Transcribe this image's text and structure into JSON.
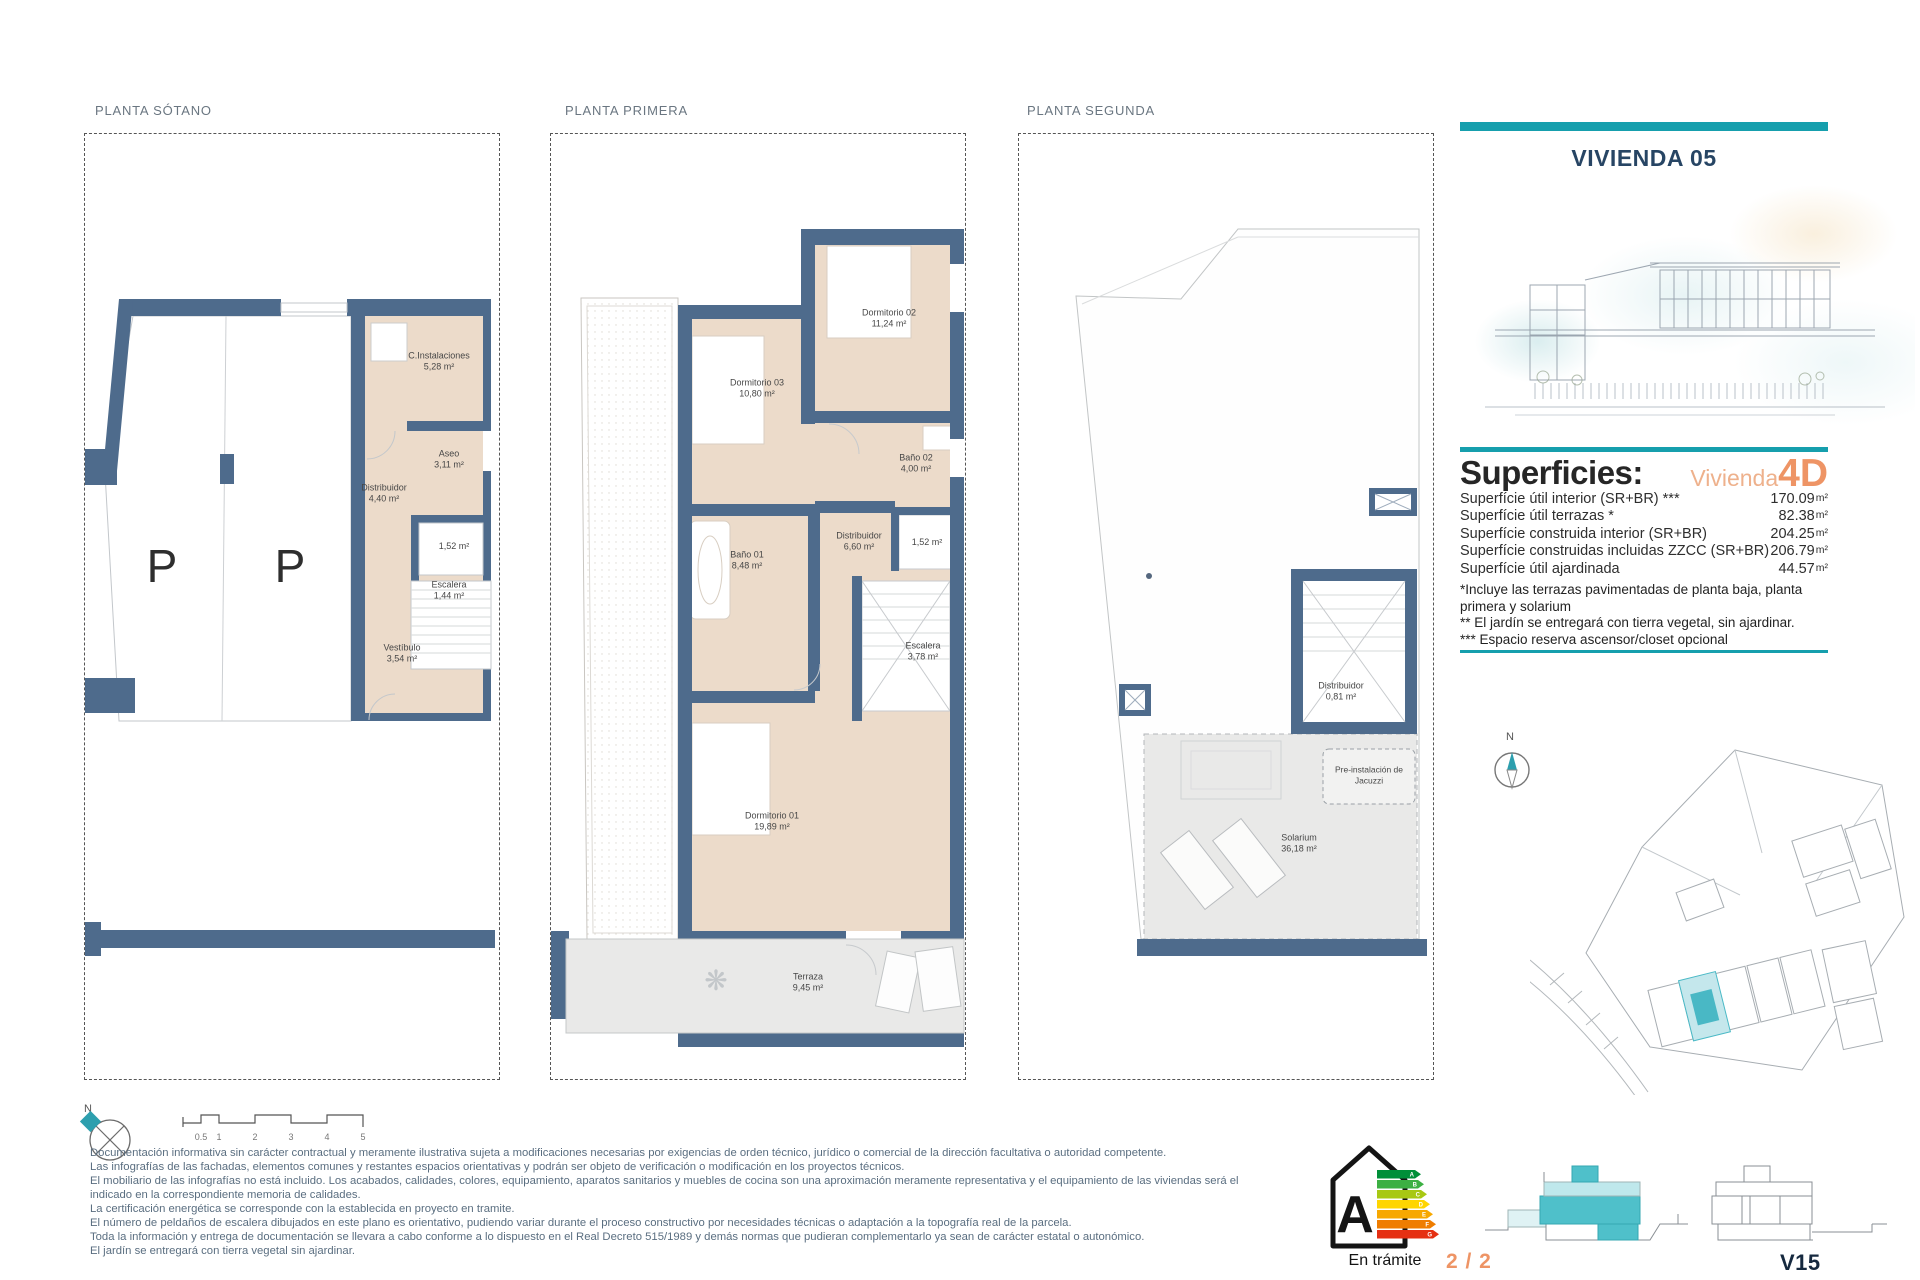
{
  "header": {
    "title": "VIVIENDA 05"
  },
  "plans": [
    {
      "title": "PLANTA SÓTANO",
      "rooms": [
        {
          "name": "C.Instalaciones",
          "area": "5,28 m²"
        },
        {
          "name": "Aseo",
          "area": "3,11 m²"
        },
        {
          "name": "Distribuidor",
          "area": "4,40 m²"
        },
        {
          "name": "",
          "area": "1,52 m²"
        },
        {
          "name": "Escalera",
          "area": "1,44 m²"
        },
        {
          "name": "Vestíbulo",
          "area": "3,54 m²"
        }
      ],
      "parking_marks": [
        "P",
        "P"
      ]
    },
    {
      "title": "PLANTA PRIMERA",
      "rooms": [
        {
          "name": "Dormitorio 02",
          "area": "11,24 m²"
        },
        {
          "name": "Dormitorio 03",
          "area": "10,80 m²"
        },
        {
          "name": "Baño 02",
          "area": "4,00 m²"
        },
        {
          "name": "Distribuidor",
          "area": "6,60 m²"
        },
        {
          "name": "",
          "area": "1,52 m²"
        },
        {
          "name": "Baño 01",
          "area": "8,48 m²"
        },
        {
          "name": "Escalera",
          "area": "3,78 m²"
        },
        {
          "name": "Dormitorio 01",
          "area": "19,89 m²"
        },
        {
          "name": "Terraza",
          "area": "9,45 m²"
        }
      ]
    },
    {
      "title": "PLANTA SEGUNDA",
      "rooms": [
        {
          "name": "Distribuidor",
          "area": "0,81 m²"
        },
        {
          "name": "Pre-instalación de Jacuzzi",
          "area": ""
        },
        {
          "name": "Solarium",
          "area": "36,18 m²"
        }
      ]
    }
  ],
  "superficies": {
    "heading": "Superficies:",
    "unit_label": "Vivienda",
    "unit_code": "4D",
    "rows": [
      {
        "label": "Superfície útil interior (SR+BR) ***",
        "value": "170.09",
        "unit": "m²"
      },
      {
        "label": "Superfície útil terrazas *",
        "value": "82.38",
        "unit": "m²"
      },
      {
        "label": "Superfície construida interior (SR+BR)",
        "value": "204.25",
        "unit": "m²"
      },
      {
        "label": "Superfície construidas incluidas ZZCC (SR+BR)",
        "value": "206.79",
        "unit": "m²"
      },
      {
        "label": "Superfície útil ajardinada",
        "value": "44.57",
        "unit": "m²"
      }
    ],
    "notes": [
      "*Incluye las terrazas pavimentadas de planta baja, planta primera y solarium",
      "** El jardín se entregará con tierra vegetal, sin ajardinar.",
      "*** Espacio reserva ascensor/closet opcional"
    ]
  },
  "legal": {
    "lines": [
      "Documentación informativa sin carácter contractual y meramente ilustrativa sujeta a modificaciones necesarias por exigencias de orden técnico, jurídico o comercial de la dirección facultativa o autoridad competente.",
      "Las infografías de las fachadas, elementos comunes y restantes espacios orientativas y podrán ser objeto de verificación o modificación en los proyectos técnicos.",
      "El mobiliario de las infografías no está incluido. Los acabados, calidades, colores, equipamiento, aparatos sanitarios y muebles de cocina son una aproximación meramente representativa y el equipamiento de las viviendas será el",
      "indicado en la correspondiente memoria de calidades.",
      "La certificación energética se corresponde con la establecida en proyecto en tramite.",
      "El número de peldaños de escalera dibujados en este plano es orientativo, pudiendo variar durante el proceso constructivo por necesidades técnicas o adaptación a la topografía real de la parcela.",
      "Toda la información y entrega de documentación se llevara a cabo conforme a lo dispuesto en el Real Decreto 515/1989 y demás normas que pudieran complementarlo ya sean de carácter estatal o autonómico.",
      "El jardín se entregará con tierra vegetal sin ajardinar."
    ]
  },
  "footer": {
    "energy_rating": "A",
    "energy_status": "En trámite",
    "energy_scale": [
      "A",
      "B",
      "C",
      "D",
      "E",
      "F",
      "G"
    ],
    "page_indicator": "2 / 2",
    "sheet_code": "V15",
    "north_label": "N",
    "scale_ticks": [
      "0.5",
      "1",
      "2",
      "3",
      "4",
      "5"
    ]
  },
  "site_plan": {
    "north_label": "N"
  },
  "colors": {
    "accent_teal": "#169fad",
    "accent_orange": "#ee9465",
    "wall_blue": "#4e6b8c",
    "floor_beige": "#ecdbca"
  }
}
